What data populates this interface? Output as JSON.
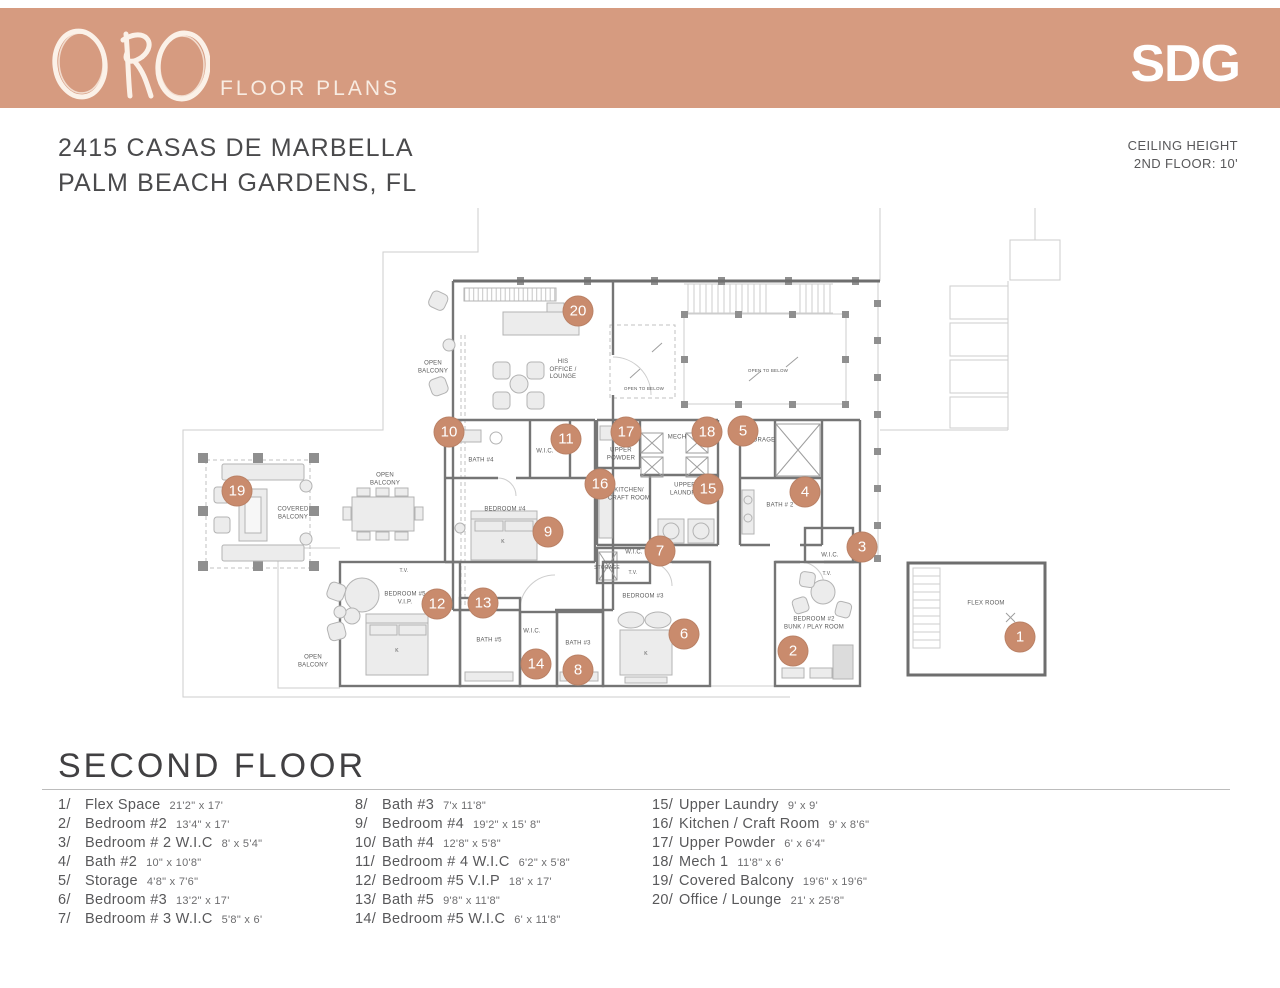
{
  "header": {
    "brand": "ORO",
    "subtitle": "FLOOR PLANS",
    "logo": "SDG"
  },
  "address": {
    "line1": "2415 CASAS DE MARBELLA",
    "line2": "PALM BEACH GARDENS, FL"
  },
  "ceiling_note": {
    "line1": "CEILING HEIGHT",
    "line2": "2ND FLOOR:  10'"
  },
  "section_title": "SECOND FLOOR",
  "colors": {
    "header_bg": "#D69B80",
    "marker": "#C98B6D"
  },
  "legend": {
    "columns": [
      [
        {
          "num": "1/",
          "name": "Flex Space",
          "dims": "21'2\" x 17'"
        },
        {
          "num": "2/",
          "name": "Bedroom #2",
          "dims": "13'4\" x 17'"
        },
        {
          "num": "3/",
          "name": "Bedroom # 2 W.I.C",
          "dims": "8' x 5'4\""
        },
        {
          "num": "4/",
          "name": "Bath #2",
          "dims": "10\" x 10'8\""
        },
        {
          "num": "5/",
          "name": "Storage",
          "dims": "4'8\" x 7'6\""
        },
        {
          "num": "6/",
          "name": "Bedroom #3",
          "dims": "13'2\" x 17'"
        },
        {
          "num": "7/",
          "name": "Bedroom # 3 W.I.C",
          "dims": "5'8\" x 6'"
        }
      ],
      [
        {
          "num": "8/",
          "name": "Bath #3",
          "dims": "7'x 11'8\""
        },
        {
          "num": "9/",
          "name": "Bedroom #4",
          "dims": "19'2\" x 15' 8\""
        },
        {
          "num": "10/",
          "name": "Bath #4",
          "dims": "12'8\" x 5'8\""
        },
        {
          "num": "11/",
          "name": "Bedroom # 4 W.I.C",
          "dims": "6'2\" x 5'8\""
        },
        {
          "num": "12/",
          "name": "Bedroom #5 V.I.P",
          "dims": "18' x 17'"
        },
        {
          "num": "13/",
          "name": "Bath #5",
          "dims": "9'8\" x 11'8\""
        },
        {
          "num": "14/",
          "name": "Bedroom #5 W.I.C",
          "dims": "6' x 11'8\""
        }
      ],
      [
        {
          "num": "15/",
          "name": "Upper Laundry",
          "dims": "9' x 9'"
        },
        {
          "num": "16/",
          "name": "Kitchen / Craft Room",
          "dims": "9' x 8'6\""
        },
        {
          "num": "17/",
          "name": "Upper Powder",
          "dims": "6' x 6'4\""
        },
        {
          "num": "18/",
          "name": "Mech 1",
          "dims": "11'8\" x 6'"
        },
        {
          "num": "19/",
          "name": "Covered Balcony",
          "dims": "19'6\" x 19'6\""
        },
        {
          "num": "20/",
          "name": "Office / Lounge",
          "dims": "21' x 25'8\""
        }
      ]
    ]
  },
  "plan": {
    "markers": [
      {
        "n": "1",
        "x": 1020,
        "y": 637
      },
      {
        "n": "2",
        "x": 793,
        "y": 651
      },
      {
        "n": "3",
        "x": 862,
        "y": 547
      },
      {
        "n": "4",
        "x": 805,
        "y": 492
      },
      {
        "n": "5",
        "x": 743,
        "y": 431
      },
      {
        "n": "6",
        "x": 684,
        "y": 634
      },
      {
        "n": "7",
        "x": 660,
        "y": 551
      },
      {
        "n": "8",
        "x": 578,
        "y": 670
      },
      {
        "n": "9",
        "x": 548,
        "y": 532
      },
      {
        "n": "10",
        "x": 449,
        "y": 432
      },
      {
        "n": "11",
        "x": 566,
        "y": 439
      },
      {
        "n": "12",
        "x": 437,
        "y": 604
      },
      {
        "n": "13",
        "x": 483,
        "y": 603
      },
      {
        "n": "14",
        "x": 536,
        "y": 664
      },
      {
        "n": "15",
        "x": 708,
        "y": 489
      },
      {
        "n": "16",
        "x": 600,
        "y": 484
      },
      {
        "n": "17",
        "x": 626,
        "y": 432
      },
      {
        "n": "18",
        "x": 707,
        "y": 432
      },
      {
        "n": "19",
        "x": 237,
        "y": 491
      },
      {
        "n": "20",
        "x": 578,
        "y": 311
      }
    ],
    "room_labels": [
      {
        "t": "OPEN\nBALCONY",
        "x": 433,
        "y": 368
      },
      {
        "t": "HIS\nOFFICE /\nLOUNGE",
        "x": 563,
        "y": 370
      },
      {
        "t": "OPEN TO BELOW",
        "x": 644,
        "y": 389,
        "s": 4.5
      },
      {
        "t": "OPEN TO BELOW",
        "x": 768,
        "y": 371,
        "s": 4.5
      },
      {
        "t": "OPEN\nBALCONY",
        "x": 385,
        "y": 480
      },
      {
        "t": "COVERED\nBALCONY",
        "x": 293,
        "y": 514
      },
      {
        "t": "BATH #4",
        "x": 481,
        "y": 461
      },
      {
        "t": "W.I.C.",
        "x": 545,
        "y": 452
      },
      {
        "t": "BEDROOM #4",
        "x": 505,
        "y": 510
      },
      {
        "t": "UPPER\nPOWDER",
        "x": 621,
        "y": 455
      },
      {
        "t": "MECH",
        "x": 677,
        "y": 438
      },
      {
        "t": "KITCHEN/\nCRAFT ROOM",
        "x": 629,
        "y": 495
      },
      {
        "t": "UPPER\nLAUNDRY",
        "x": 685,
        "y": 490
      },
      {
        "t": "STORAGE",
        "x": 760,
        "y": 441
      },
      {
        "t": "BATH # 2",
        "x": 780,
        "y": 506
      },
      {
        "t": "W.I.C.",
        "x": 634,
        "y": 553
      },
      {
        "t": "STORAGE",
        "x": 607,
        "y": 568,
        "s": 5
      },
      {
        "t": "BEDROOM #5\nV.I.P.",
        "x": 405,
        "y": 599
      },
      {
        "t": "BATH #5",
        "x": 489,
        "y": 641
      },
      {
        "t": "W.I.C.",
        "x": 532,
        "y": 632
      },
      {
        "t": "BATH #3",
        "x": 578,
        "y": 644
      },
      {
        "t": "BEDROOM #3",
        "x": 643,
        "y": 597
      },
      {
        "t": "BEDROOM #2\nBUNK / PLAY ROOM",
        "x": 814,
        "y": 624
      },
      {
        "t": "W.I.C.",
        "x": 830,
        "y": 556
      },
      {
        "t": "FLEX ROOM",
        "x": 986,
        "y": 604
      },
      {
        "t": "OPEN\nBALCONY",
        "x": 313,
        "y": 662
      },
      {
        "t": "T.V.",
        "x": 404,
        "y": 571,
        "s": 5
      },
      {
        "t": "T.V.",
        "x": 633,
        "y": 573,
        "s": 5
      },
      {
        "t": "T.V.",
        "x": 827,
        "y": 574,
        "s": 5
      },
      {
        "t": "K",
        "x": 503,
        "y": 542,
        "s": 5
      },
      {
        "t": "K",
        "x": 397,
        "y": 651,
        "s": 5
      },
      {
        "t": "K",
        "x": 646,
        "y": 654,
        "s": 5
      }
    ]
  }
}
